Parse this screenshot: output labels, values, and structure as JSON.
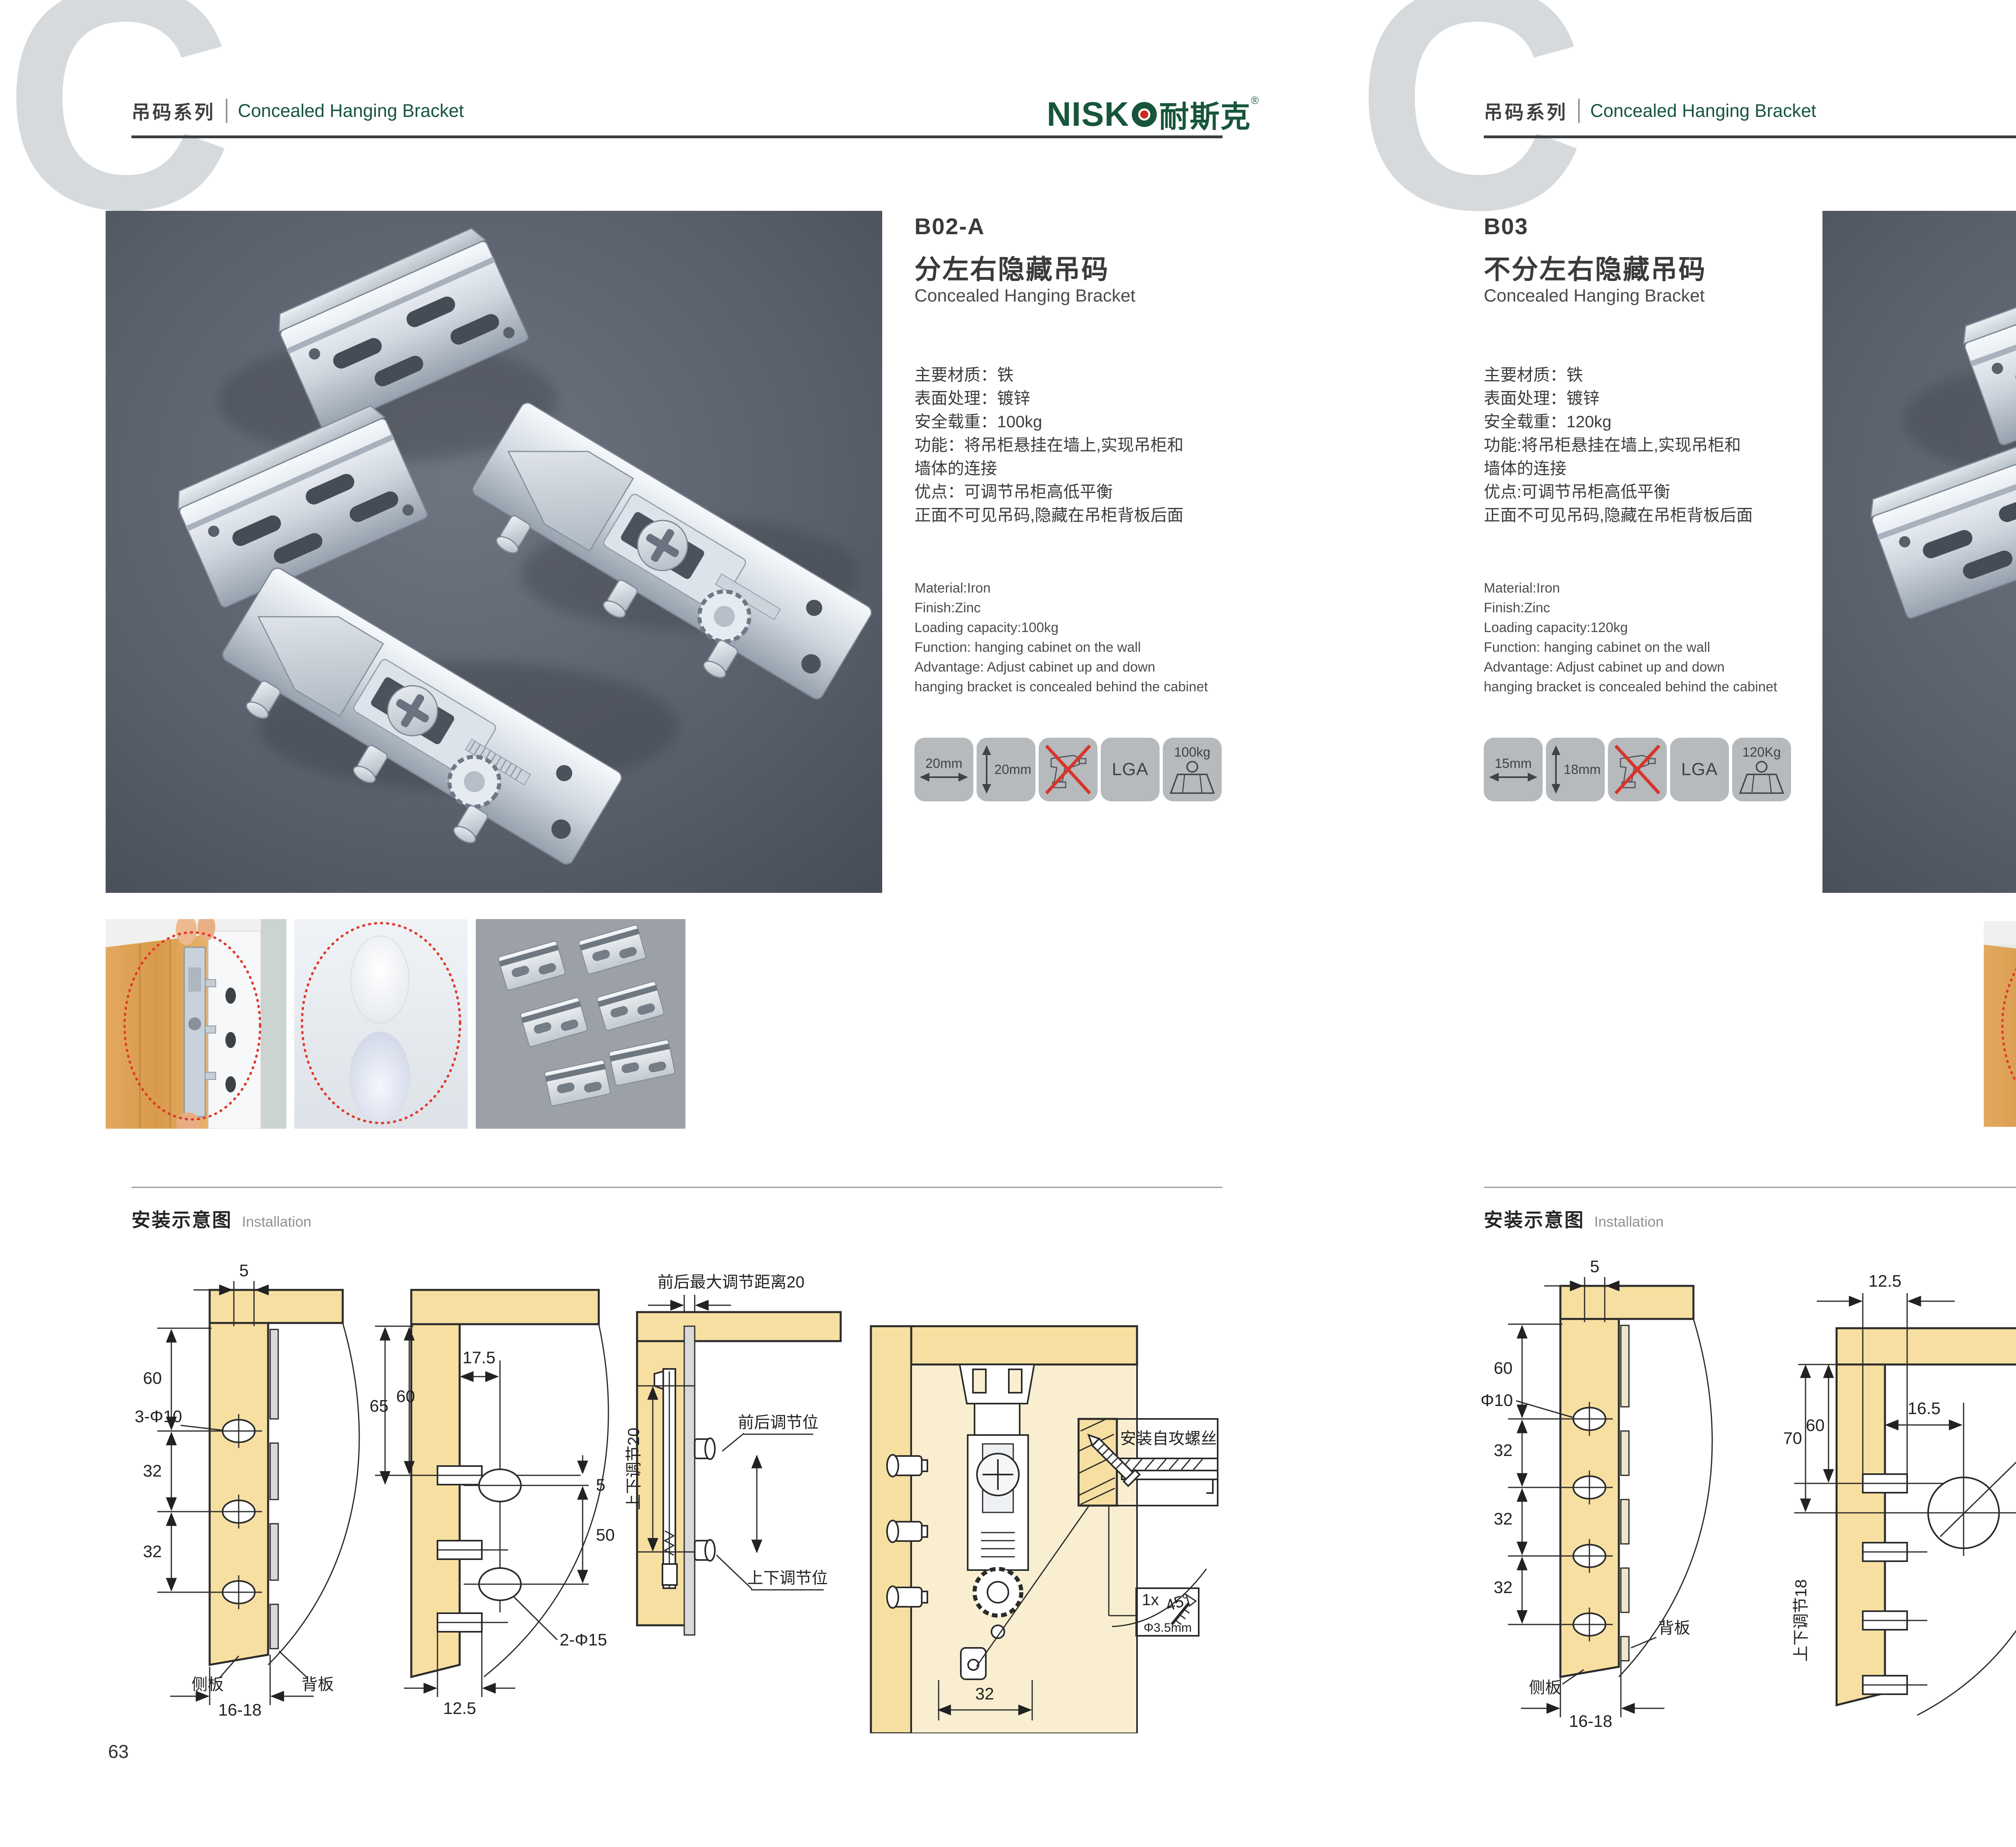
{
  "header": {
    "series_cn": "吊码系列",
    "series_en": "Concealed Hanging Bracket",
    "bg_letter": "C",
    "brand_text": "NISK",
    "brand_cn": "耐斯克",
    "registered": "®"
  },
  "install": {
    "title_cn": "安装示意图",
    "title_en": "Installation"
  },
  "page63": {
    "number": "63",
    "code": "B02-A",
    "title_cn": "分左右隐藏吊码",
    "title_en": "Concealed Hanging Bracket",
    "specs_cn": [
      "主要材质：铁",
      "表面处理：镀锌",
      "安全载重：100kg",
      "功能：将吊柜悬挂在墙上,实现吊柜和",
      "墙体的连接",
      "优点：可调节吊柜高低平衡",
      "正面不可见吊码,隐藏在吊柜背板后面"
    ],
    "specs_en": [
      "Material:Iron",
      "Finish:Zinc",
      "Loading capacity:100kg",
      "Function: hanging cabinet on the wall",
      "Advantage: Adjust cabinet up and down",
      "hanging bracket is concealed behind the cabinet"
    ],
    "icons": {
      "width": "20mm",
      "height": "20mm",
      "cert": "LGA",
      "load": "100kg"
    },
    "d1": {
      "top": "5",
      "h": "60",
      "hole": "3-Φ10",
      "s1": "32",
      "s2": "32",
      "side": "侧板",
      "back": "背板",
      "bottom": "16-18"
    },
    "d2": {
      "l1": "65",
      "l2": "60",
      "t": "17.5",
      "g": "5",
      "m": "50",
      "hole": "2-Φ15",
      "b": "12.5"
    },
    "d3": {
      "top": "前后最大调节距离20",
      "left": "上下调节20",
      "r1": "前后调节位",
      "r2": "上下调节位"
    },
    "d4": {
      "w": "32",
      "screw": "安装自攻螺丝",
      "angle": "45°",
      "qty": "1x",
      "dia": "Φ3.5mm"
    }
  },
  "page64": {
    "number": "64",
    "code": "B03",
    "title_cn": "不分左右隐藏吊码",
    "title_en": "Concealed Hanging Bracket",
    "specs_cn": [
      "主要材质：铁",
      "表面处理：镀锌",
      "安全载重：120kg",
      "功能:将吊柜悬挂在墙上,实现吊柜和",
      "墙体的连接",
      "优点:可调节吊柜高低平衡",
      "正面不可见吊码,隐藏在吊柜背板后面"
    ],
    "specs_en": [
      "Material:Iron",
      "Finish:Zinc",
      "Loading capacity:120kg",
      "Function: hanging cabinet on the wall",
      "Advantage: Adjust cabinet up and down",
      "hanging bracket is concealed behind the cabinet"
    ],
    "icons": {
      "width": "15mm",
      "height": "18mm",
      "cert": "LGA",
      "load": "120Kg"
    },
    "d1": {
      "top": "5",
      "h": "60",
      "hole": "Φ10",
      "s1": "32",
      "s2": "32",
      "s3": "32",
      "back": "背板",
      "side": "侧板",
      "bottom": "16-18"
    },
    "d2": {
      "t": "12.5",
      "l1": "70",
      "l2": "60",
      "i": "16.5",
      "hole": "Ø 25",
      "off": "10",
      "vert": "上下调节18"
    },
    "d3": {
      "t": "16.5",
      "l": "12.5",
      "off": "10",
      "hole": "Ø25",
      "lock": "锁紧状态",
      "screw": "安装自攻螺丝",
      "angle": "45°",
      "qty": "1x",
      "dia": "Φ3.5mm"
    }
  }
}
